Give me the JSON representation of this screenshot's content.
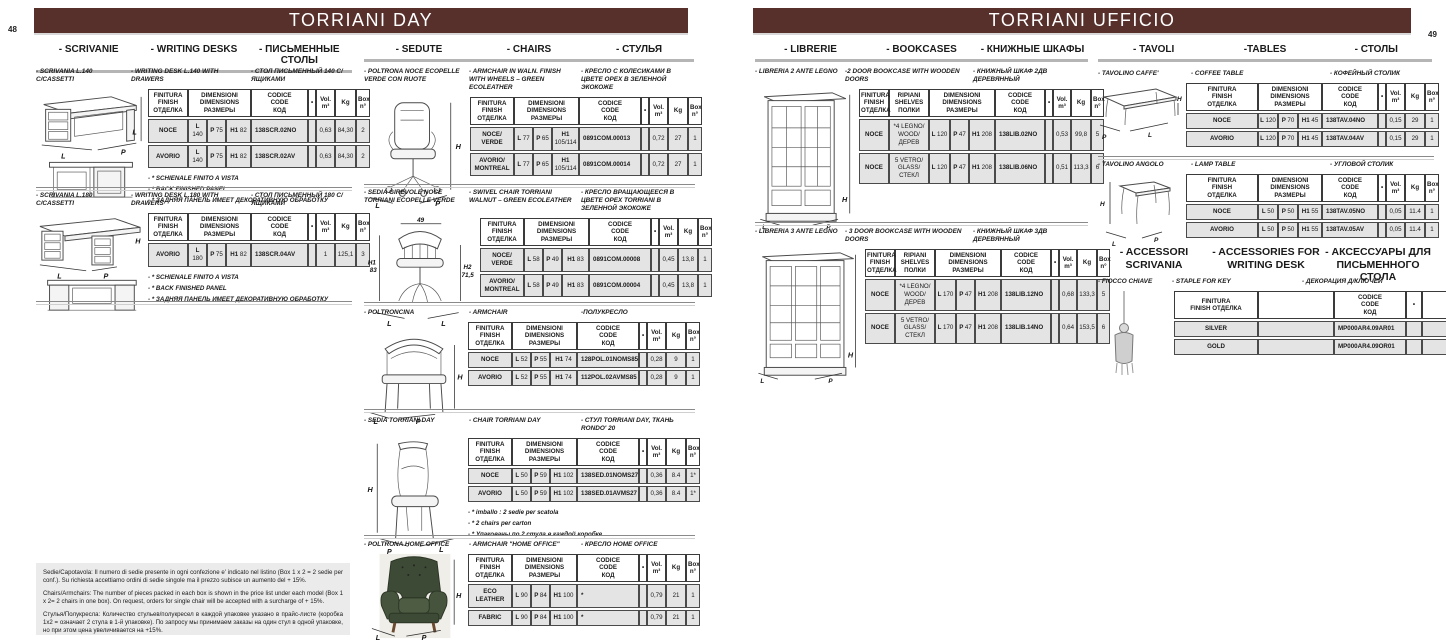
{
  "colors": {
    "accent": "#572f2b",
    "table_row": "#e4e4e4",
    "underline": "#b5b5b5"
  },
  "headers": {
    "std": [
      {
        "t": "FINITURA\nFINISH\nОТДЕЛКА"
      },
      {
        "t": "DIMENSIONI\nDIMENSIONS\nРАЗМЕРЫ",
        "span": 3
      },
      {
        "t": "CODICE\nCODE\nКОД"
      },
      {
        "t": "•"
      },
      {
        "t": "Vol.\nm³"
      },
      {
        "t": "Kg"
      },
      {
        "t": "Box\nn°"
      }
    ],
    "shelves": [
      {
        "t": "FINITURA\nFINISH\nОТДЕЛКА"
      },
      {
        "t": "RIPIANI\nSHELVES\nПОЛКИ"
      },
      {
        "t": "DIMENSIONI\nDIMENSIONS\nРАЗМЕРЫ",
        "span": 3
      },
      {
        "t": "CODICE\nCODE\nКОД"
      },
      {
        "t": "•"
      },
      {
        "t": "Vol.\nm³"
      },
      {
        "t": "Kg"
      },
      {
        "t": "Box\nn°"
      }
    ],
    "accessory": [
      {
        "t": "FINITURA\nFINISH ОТДЕЛКА"
      },
      {
        "t": ""
      },
      {
        "t": "CODICE\nCODE\nКОД"
      },
      {
        "t": "•"
      },
      {
        "t": ""
      }
    ]
  },
  "page_left": {
    "page_number": "48",
    "title": "TORRIANI DAY",
    "sections": {
      "scrivanie": {
        "labels": [
          "- SCRIVANIE",
          "- WRITING DESKS",
          "- ПИСЬМЕННЫЕ СТОЛЫ"
        ]
      },
      "sedute": {
        "labels": [
          "- SEDUTE",
          "- CHAIRS",
          "- СТУЛЬЯ"
        ]
      }
    },
    "products": {
      "desk140": {
        "title_it": "- SCRIVANIA L.140 C/CASSETTI",
        "title_en": "- WRITING DESK L.140 WITH DRAWERS",
        "title_ru": "- СТОЛ ПИСЬМЕННЫЙ 140 С/ЯЩИКАМИ",
        "fig_labels": {
          "h": "L",
          "l": "L",
          "p": "P"
        },
        "rows": [
          [
            "NOCE",
            "L 140",
            "P 75",
            "H1 82",
            "138SCR.02NO",
            "",
            "0,63",
            "84,30",
            "2"
          ],
          [
            "AVORIO",
            "L 140",
            "P 75",
            "H1 82",
            "138SCR.02AV",
            "",
            "0,63",
            "84,30",
            "2"
          ]
        ],
        "notes": [
          "- * SCHIENALE FINITO A VISTA",
          "- * BACK FINISHED PANEL",
          "- * ЗАДНЯЯ ПАНЕЛЬ ИМЕЕТ ДЕКОРАТИВНУЮ ОБРАБОТКУ"
        ]
      },
      "desk180": {
        "title_it": "- SCRIVANIA L.180 C/CASSETTI",
        "title_en": "- WRITING DESK L.180 WITH DRAWERS",
        "title_ru": "- СТОЛ ПИСЬМЕННЫЙ 180 С/ЯЩИКАМИ",
        "fig_labels": {
          "h": "H",
          "l": "L",
          "p": "P"
        },
        "rows": [
          [
            "AVORIO",
            "L 180",
            "P 75",
            "H1 82",
            "138SCR.04AV",
            "",
            "1",
            "125,1",
            "3"
          ]
        ],
        "notes": [
          "- * SCHIENALE FINITO A VISTA",
          "- * BACK FINISHED PANEL",
          "- * ЗАДНЯЯ ПАНЕЛЬ ИМЕЕТ ДЕКОРАТИВНУЮ ОБРАБОТКУ"
        ]
      },
      "armchair_wheels": {
        "title_it": "- POLTRONA NOCE ECOPELLE VERDE CON RUOTE",
        "title_en": "- ARMCHAIR IN WALN. FINISH WITH WHEELS – GREEN ECOLEATHER",
        "title_ru": "- КРЕСЛО С КОЛЕСИКАМИ В ЦВЕТЕ ОРЕХ В ЗЕЛЕННОЙ ЭКОКОЖЕ",
        "fig_labels": {
          "h": "H",
          "l": "L",
          "p": "P"
        },
        "rows": [
          [
            "NOCE/\nVERDE",
            "L 77",
            "P 65",
            "H1 105/114",
            "0891COM.00013",
            "",
            "0,72",
            "27",
            "1"
          ],
          [
            "AVORIO/\nMONTREAL",
            "L 77",
            "P 65",
            "H1 105/114",
            "0891COM.00014",
            "",
            "0,72",
            "27",
            "1"
          ]
        ]
      },
      "swivel_chair": {
        "title_it": "- SEDIA GIREVOLE NOCE TORRIANI ECOPELLE VERDE",
        "title_en": "- SWIVEL CHAIR  TORRIANI  WALNUT – GREEN ECOLEATHER",
        "title_ru": "- КРЕСЛО ВРАЩАЮЩЕЕСЯ В ЦВЕТЕ ОРЕХ TORRIANI В ЗЕЛЕННОЙ ЭКОКОЖЕ",
        "fig_labels": {
          "w": "49",
          "h1": "H1",
          "h1v": "83",
          "h2": "H2",
          "h2v": "71,5",
          "l1": "L",
          "l2": "L"
        },
        "rows": [
          [
            "NOCE/\nVERDE",
            "L 58",
            "P 49",
            "H1 83",
            "0891COM.00008",
            "",
            "0,45",
            "13,8",
            "1"
          ],
          [
            "AVORIO/\nMONTREAL",
            "L 58",
            "P 49",
            "H1 83",
            "0891COM.00004",
            "",
            "0,45",
            "13,8",
            "1"
          ]
        ]
      },
      "poltroncina": {
        "title_it": "- POLTRONCINA",
        "title_en": "- ARMCHAIR",
        "title_ru": "-ПОЛУКРЕСЛО",
        "fig_labels": {
          "h": "H",
          "l": "L",
          "p": "P"
        },
        "rows": [
          [
            "NOCE",
            "L 52",
            "P 55",
            "H1 74",
            "128POL.01NOMS85",
            "",
            "0,28",
            "9",
            "1"
          ],
          [
            "AVORIO",
            "L 52",
            "P 55",
            "H1 74",
            "112POL.02AVMS85",
            "",
            "0,28",
            "9",
            "1"
          ]
        ]
      },
      "sedia_day": {
        "title_it": "- SEDIA TORRIANI DAY",
        "title_en": "- CHAIR TORRIANI DAY",
        "title_ru": "- СТУЛ TORRIANI DAY, ТКАНЬ RONDO' 20",
        "fig_labels": {
          "h": "H",
          "p": "P",
          "l": "L"
        },
        "rows": [
          [
            "NOCE",
            "L 50",
            "P 59",
            "H1 102",
            "138SED.01NOMS27",
            "",
            "0,36",
            "8.4",
            "1*"
          ],
          [
            "AVORIO",
            "L 50",
            "P 59",
            "H1 102",
            "138SED.01AVMS27",
            "",
            "0,36",
            "8.4",
            "1*"
          ]
        ],
        "notes": [
          "- * imballo : 2 sedie per scatola",
          "- * 2 chairs per carton",
          "- * Упакованы по 2 стула в каждой коробке"
        ]
      },
      "home_office": {
        "title_it": "- POLTRONA HOME OFFICE",
        "title_en": "- ARMCHAIR \"HOME OFFICE\"",
        "title_ru": "- КРЕСЛО HOME OFFICE",
        "fig_labels": {
          "h": "H",
          "l": "L",
          "p": "P"
        },
        "rows": [
          [
            "ECO\nLEATHER",
            "L 90",
            "P 84",
            "H1 100",
            "*",
            "",
            "0,79",
            "21",
            "1"
          ],
          [
            "FABRIC",
            "L 90",
            "P 84",
            "H1 100",
            "*",
            "",
            "0,79",
            "21",
            "1"
          ]
        ]
      }
    },
    "footer_notes": [
      "Sedie/Capotavola: Il numero di sedie presente in ogni confezione e' indicato nel listino (Box 1 x 2 = 2 sedie per conf.). Su richiesta accettiamo ordini di sedie singole ma il prezzo  subisce un aumento del  + 15%.",
      "Chairs/Armchairs: The number of pieces packed in each box is shown in the price list under each model (Box 1 x 2= 2 chairs in one box). On request, orders for  single chair will be accepted with a surcharge  of  + 15%.",
      "Стулья/Полукресла: Количество стульев/полукресел в каждой упаковке указано в прайс-листе (коробка 1x2 = означает 2 стула в 1-й упаковке). По запросу мы принимаем заказы на один стул в одной упаковке, но при этом цена увеличивается на +15%."
    ]
  },
  "page_right": {
    "page_number": "49",
    "title": "TORRIANI UFFICIO",
    "sections": {
      "librerie": {
        "labels": [
          "- LIBRERIE",
          "- BOOKCASES",
          "- КНИЖНЫЕ ШКАФЫ"
        ]
      },
      "tavoli": {
        "labels": [
          "- TAVOLI",
          "-TABLES",
          "- СТОЛЫ"
        ]
      },
      "accessori": {
        "labels": [
          "- ACCESSORI\nSCRIVANIA",
          "- ACCESSORIES FOR\nWRITING DESK",
          "- АКСЕССУАРЫ ДЛЯ\nПИСЬМЕННОГО СТОЛА"
        ]
      }
    },
    "products": {
      "libreria2": {
        "title_it": "- LIBRERIA 2 ANTE LEGNO",
        "title_en": "-2 DOOR BOOKCASE WITH WOODEN DOORS",
        "title_ru": "- КНИЖНЫЙ ШКАФ 2ДВ ДЕРЕВЯННЫЙ",
        "fig_labels": {
          "h": "H",
          "l": "L",
          "p": "P"
        },
        "rows": [
          [
            "NOCE",
            "*4 LEGNO/\nWOOD/ДЕРЕВ",
            "L 120",
            "P 47",
            "H1 208",
            "138LIB.02NO",
            "",
            "0,53",
            "99,8",
            "5"
          ],
          [
            "NOCE",
            "5 VETRO/\nGLASS/СТЕКЛ",
            "L 120",
            "P 47",
            "H1 208",
            "138LIB.06NO",
            "",
            "0,51",
            "113,3",
            "6"
          ]
        ]
      },
      "libreria3": {
        "title_it": "- LIBRERIA 3 ANTE LEGNO",
        "title_en": "- 3 DOOR BOOKCASE WITH WOODEN DOORS",
        "title_ru": "- КНИЖНЫЙ ШКАФ 3ДВ ДЕРЕВЯННЫЙ",
        "fig_labels": {
          "h": "H",
          "l": "L",
          "p": "P"
        },
        "rows": [
          [
            "NOCE",
            "*4 LEGNO/\nWOOD/ДЕРЕВ",
            "L 170",
            "P 47",
            "H1 208",
            "138LIB.12NO",
            "",
            "0,68",
            "133,3",
            "5"
          ],
          [
            "NOCE",
            "5 VETRO/\nGLASS/СТЕКЛ",
            "L 170",
            "P 47",
            "H1 208",
            "138LIB.14NO",
            "",
            "0,64",
            "153,5",
            "6"
          ]
        ]
      },
      "tavolino_caffe": {
        "title_it": "- TAVOLINO CAFFE'",
        "title_en": "- COFFEE TABLE",
        "title_ru": "- КОФЕЙНЫЙ СТОЛИК",
        "fig_labels": {
          "h": "H",
          "p": "P",
          "l": "L"
        },
        "rows": [
          [
            "NOCE",
            "L 120",
            "P 70",
            "H1 45",
            "138TAV.04NO",
            "",
            "0,15",
            "29",
            "1"
          ],
          [
            "AVORIO",
            "L 120",
            "P 70",
            "H1 45",
            "138TAV.04AV",
            "",
            "0,15",
            "29",
            "1"
          ]
        ]
      },
      "tavolino_angolo": {
        "title_it": "- TAVOLINO ANGOLO",
        "title_en": "- LAMP TABLE",
        "title_ru": "- УГЛОВОЙ СТОЛИК",
        "fig_labels": {
          "h": "H",
          "l": "L",
          "p": "P"
        },
        "rows": [
          [
            "NOCE",
            "L 50",
            "P 50",
            "H1 55",
            "138TAV.05NO",
            "",
            "0,05",
            "11.4",
            "1"
          ],
          [
            "AVORIO",
            "L 50",
            "P 50",
            "H1 55",
            "138TAV.05AV",
            "",
            "0,05",
            "11.4",
            "1"
          ]
        ]
      },
      "fiocco_chiave": {
        "title_it": "- FIOCCO CHIAVE",
        "title_en": "- STAPLE FOR KEY",
        "title_ru": "- ДЕКОРАЦИЯ Д/КЛЮЧЕЙ",
        "rows": [
          [
            "SILVER",
            "",
            "MP000AR4.09AR01",
            "",
            ""
          ],
          [
            "GOLD",
            "",
            "MP000AR4.09OR01",
            "",
            ""
          ]
        ]
      }
    }
  }
}
